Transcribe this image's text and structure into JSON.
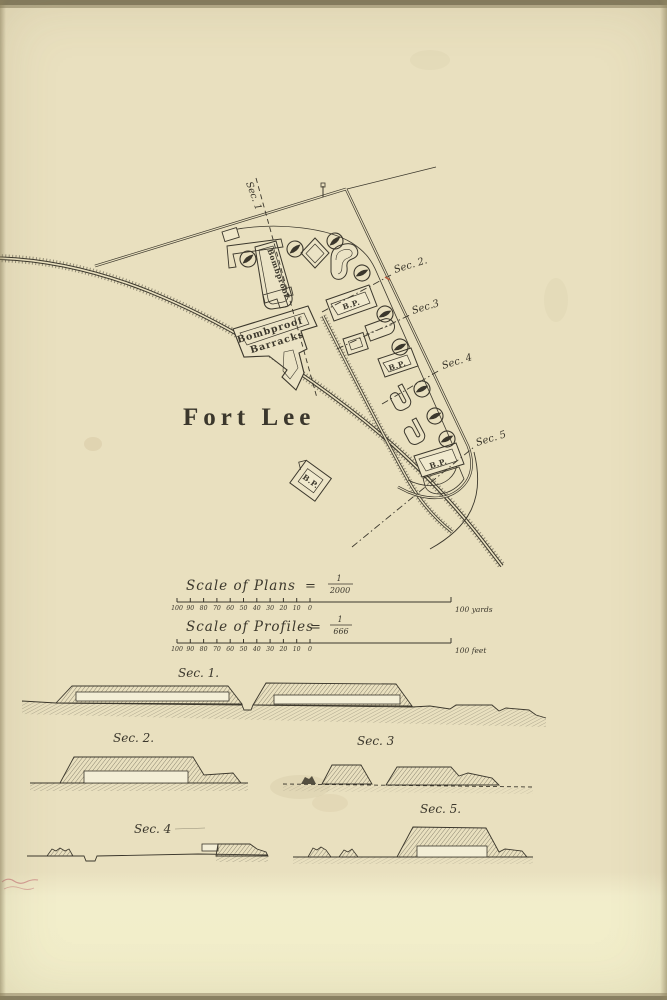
{
  "colors": {
    "paper": "#e9e0bf",
    "paper_lower": "#f2eecb",
    "ink": "#3b372c",
    "edge_band": "#8b8366",
    "red_survey_mark": "#bb5a3a"
  },
  "map": {
    "fort_name": "Fort Lee",
    "bombproof_building_label": "Bombproof",
    "barracks_label_line1": "Bombproof",
    "barracks_label_line2": "Barracks",
    "bp_abbreviation": "B.P.",
    "section_line_labels": {
      "sec1": "Sec. 1",
      "sec2": "Sec. 2.",
      "sec3": "Sec.3",
      "sec4": "Sec. 4",
      "sec5": "Sec. 5"
    }
  },
  "scale_block": {
    "plans": {
      "title": "Scale of Plans",
      "equals_sign": "=",
      "fraction_numerator": "1",
      "fraction_denominator": "2000",
      "tick_labels": [
        "100",
        "90",
        "80",
        "70",
        "60",
        "50",
        "40",
        "30",
        "20",
        "10",
        "0"
      ],
      "end_label": "100 yards"
    },
    "profiles": {
      "title": "Scale of Profiles",
      "equals_sign": "=",
      "fraction_numerator": "1",
      "fraction_denominator": "666",
      "tick_labels": [
        "100",
        "90",
        "80",
        "70",
        "60",
        "50",
        "40",
        "30",
        "20",
        "10",
        "0"
      ],
      "end_label": "100 feet"
    }
  },
  "profile_labels": {
    "sec1": "Sec. 1.",
    "sec2": "Sec. 2.",
    "sec3": "Sec. 3",
    "sec4": "Sec. 4",
    "sec5": "Sec. 5."
  }
}
